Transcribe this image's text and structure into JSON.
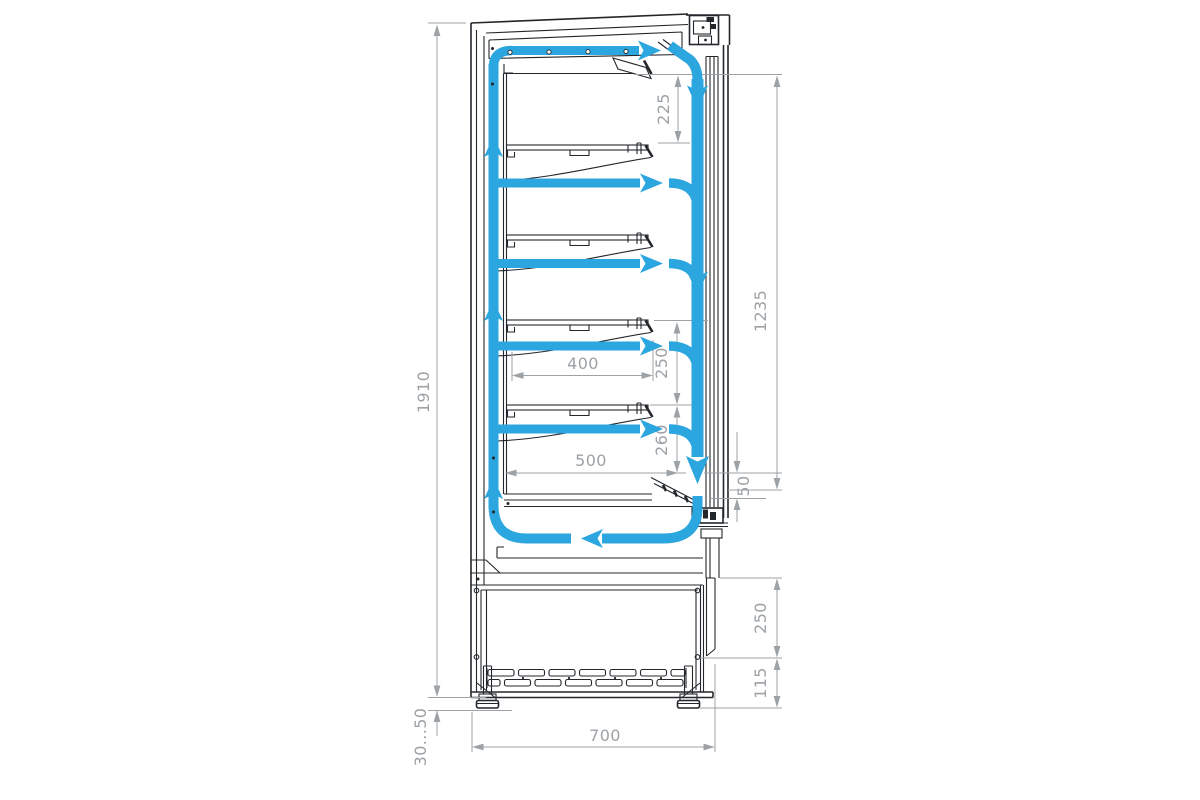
{
  "drawing": {
    "type": "technical-section",
    "colors": {
      "airflow": "#2CA6DF",
      "structure": "#23272B",
      "dimension": "#9DA2A6",
      "background": "#FFFFFF"
    }
  },
  "dims": {
    "overall_height": "1910",
    "top_clearance": "225",
    "opening_height": "1235",
    "shelf_pitch": "250",
    "shelf_width": "400",
    "bottom_shelf_clearance": "260",
    "deck_width": "500",
    "air_gap": "50",
    "machine_bay_height": "250",
    "vent_grille_height": "115",
    "leg_height_range": "30...50",
    "overall_depth": "700"
  }
}
